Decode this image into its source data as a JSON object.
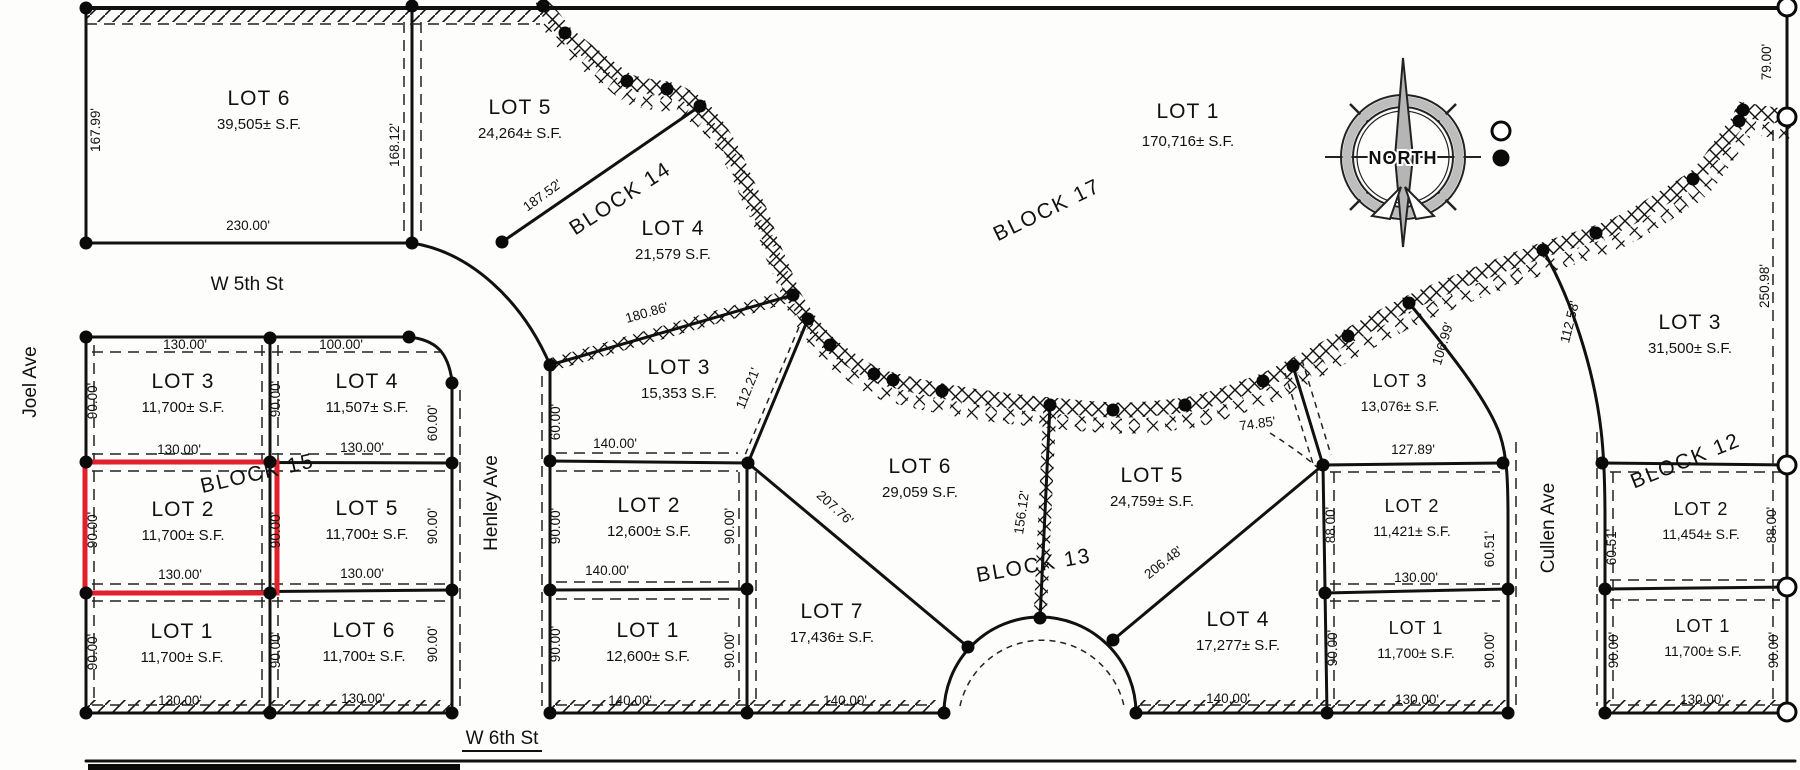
{
  "compass": {
    "label": "NORTH"
  },
  "highlight": {
    "color": "#e0202a"
  },
  "streets": [
    {
      "id": "w-5th-st",
      "label": "W 5th St",
      "x": 247,
      "y": 290,
      "r": 0
    },
    {
      "id": "joel-ave",
      "label": "Joel Ave",
      "x": 36,
      "y": 382,
      "r": -90
    },
    {
      "id": "henley-ave",
      "label": "Henley Ave",
      "x": 497,
      "y": 503,
      "r": -90
    },
    {
      "id": "cullen-ave",
      "label": "Cullen Ave",
      "x": 1554,
      "y": 528,
      "r": -90
    },
    {
      "id": "w-6th-st",
      "label": "W 6th St",
      "x": 502,
      "y": 744,
      "r": 0,
      "underline": true
    }
  ],
  "blocks": [
    {
      "id": "block-14",
      "label": "BLOCK  14",
      "x": 624,
      "y": 204,
      "r": -33
    },
    {
      "id": "block-15",
      "label": "BLOCK  15",
      "x": 259,
      "y": 480,
      "r": -13
    },
    {
      "id": "block-17",
      "label": "BLOCK  17",
      "x": 1050,
      "y": 216,
      "r": -26
    },
    {
      "id": "block-13",
      "label": "BLOCK  13",
      "x": 1035,
      "y": 572,
      "r": -10
    },
    {
      "id": "block-12",
      "label": "BLOCK  12",
      "x": 1688,
      "y": 467,
      "r": -22
    }
  ],
  "lots": [
    {
      "id": "b14-lot6",
      "name": "LOT 6",
      "area": "39,505± S.F.",
      "x": 259,
      "y": 105
    },
    {
      "id": "b14-lot5",
      "name": "LOT 5",
      "area": "24,264± S.F.",
      "x": 520,
      "y": 114
    },
    {
      "id": "b14-lot4",
      "name": "LOT 4",
      "area": "21,579 S.F.",
      "x": 673,
      "y": 235
    },
    {
      "id": "b14-lot3",
      "name": "LOT 3",
      "area": "15,353 S.F.",
      "x": 679,
      "y": 374
    },
    {
      "id": "b17-lot1",
      "name": "LOT 1",
      "area": "170,716± S.F.",
      "x": 1188,
      "y": 118,
      "gap": 28
    },
    {
      "id": "b15-lot3",
      "name": "LOT 3",
      "area": "11,700± S.F.",
      "x": 183,
      "y": 388
    },
    {
      "id": "b15-lot4",
      "name": "LOT 4",
      "area": "11,507± S.F.",
      "x": 367,
      "y": 388
    },
    {
      "id": "b15-lot2",
      "name": "LOT 2",
      "area": "11,700± S.F.",
      "x": 183,
      "y": 516,
      "highlighted": true
    },
    {
      "id": "b15-lot5",
      "name": "LOT 5",
      "area": "11,700± S.F.",
      "x": 367,
      "y": 515
    },
    {
      "id": "b15-lot1",
      "name": "LOT 1",
      "area": "11,700± S.F.",
      "x": 182,
      "y": 638
    },
    {
      "id": "b15-lot6",
      "name": "LOT 6",
      "area": "11,700± S.F.",
      "x": 364,
      "y": 637
    },
    {
      "id": "b13-lot2-west",
      "name": "LOT 2",
      "area": "12,600± S.F.",
      "x": 649,
      "y": 512
    },
    {
      "id": "b13-lot1-west",
      "name": "LOT 1",
      "area": "12,600± S.F.",
      "x": 648,
      "y": 637
    },
    {
      "id": "b13-lot7",
      "name": "LOT 7",
      "area": "17,436± S.F.",
      "x": 832,
      "y": 618
    },
    {
      "id": "b13-lot6",
      "name": "LOT 6",
      "area": "29,059 S.F.",
      "x": 920,
      "y": 473
    },
    {
      "id": "b13-lot5",
      "name": "LOT 5",
      "area": "24,759± S.F.",
      "x": 1152,
      "y": 482
    },
    {
      "id": "b13-lot4",
      "name": "LOT 4",
      "area": "17,277± S.F.",
      "x": 1238,
      "y": 626
    },
    {
      "id": "b13-lot3",
      "name": "LOT 3",
      "area": "13,076± S.F.",
      "x": 1400,
      "y": 387,
      "small": true
    },
    {
      "id": "b13-lot2-east",
      "name": "LOT 2",
      "area": "11,421± S.F.",
      "x": 1412,
      "y": 512,
      "small": true
    },
    {
      "id": "b13-lot1-east",
      "name": "LOT 1",
      "area": "11,700± S.F.",
      "x": 1416,
      "y": 634,
      "small": true
    },
    {
      "id": "b12-lot3",
      "name": "LOT 3",
      "area": "31,500± S.F.",
      "x": 1690,
      "y": 329
    },
    {
      "id": "b12-lot2",
      "name": "LOT 2",
      "area": "11,454± S.F.",
      "x": 1701,
      "y": 515,
      "small": true
    },
    {
      "id": "b12-lot1",
      "name": "LOT 1",
      "area": "11,700± S.F.",
      "x": 1703,
      "y": 632,
      "small": true
    }
  ],
  "dimensions": [
    {
      "t": "167.99'",
      "x": 100,
      "y": 130,
      "r": -90
    },
    {
      "t": "230.00'",
      "x": 248,
      "y": 230
    },
    {
      "t": "168.12'",
      "x": 399,
      "y": 145,
      "r": -90
    },
    {
      "t": "187.52'",
      "x": 545,
      "y": 199,
      "r": -36
    },
    {
      "t": "180.86'",
      "x": 648,
      "y": 317,
      "r": -16
    },
    {
      "t": "112.21'",
      "x": 752,
      "y": 390,
      "r": -68
    },
    {
      "t": "79.00'",
      "x": 1771,
      "y": 62,
      "r": -90
    },
    {
      "t": "250.98'",
      "x": 1769,
      "y": 286,
      "r": -90
    },
    {
      "t": "106.99'",
      "x": 1447,
      "y": 345,
      "r": -73
    },
    {
      "t": "112.58'",
      "x": 1574,
      "y": 323,
      "r": -76
    },
    {
      "t": "74.85'",
      "x": 1258,
      "y": 428,
      "r": -8
    },
    {
      "t": "127.89'",
      "x": 1413,
      "y": 454
    },
    {
      "t": "130.00'",
      "x": 185,
      "y": 349
    },
    {
      "t": "100.00'",
      "x": 341,
      "y": 349
    },
    {
      "t": "90.00'",
      "x": 97,
      "y": 401,
      "r": -90
    },
    {
      "t": "90.00'",
      "x": 280,
      "y": 399,
      "r": -90
    },
    {
      "t": "130.00'",
      "x": 179,
      "y": 454
    },
    {
      "t": "130.00'",
      "x": 362,
      "y": 452
    },
    {
      "t": "60.00'",
      "x": 437,
      "y": 423,
      "r": -90
    },
    {
      "t": "60.00'",
      "x": 560,
      "y": 422,
      "r": -90
    },
    {
      "t": "140.00'",
      "x": 615,
      "y": 448
    },
    {
      "t": "90.00'",
      "x": 97,
      "y": 530,
      "r": -90
    },
    {
      "t": "90.00'",
      "x": 280,
      "y": 530,
      "r": -90
    },
    {
      "t": "90.00'",
      "x": 437,
      "y": 526,
      "r": -90
    },
    {
      "t": "90.00'",
      "x": 560,
      "y": 526,
      "r": -90
    },
    {
      "t": "90.00'",
      "x": 734,
      "y": 526,
      "r": -90
    },
    {
      "t": "130.00'",
      "x": 180,
      "y": 579
    },
    {
      "t": "130.00'",
      "x": 362,
      "y": 578
    },
    {
      "t": "140.00'",
      "x": 607,
      "y": 575
    },
    {
      "t": "90.00'",
      "x": 97,
      "y": 652,
      "r": -90
    },
    {
      "t": "90.00'",
      "x": 280,
      "y": 650,
      "r": -90
    },
    {
      "t": "90.00'",
      "x": 437,
      "y": 644,
      "r": -90
    },
    {
      "t": "90.00'",
      "x": 560,
      "y": 644,
      "r": -90
    },
    {
      "t": "90.00'",
      "x": 734,
      "y": 650,
      "r": -90
    },
    {
      "t": "130.00'",
      "x": 180,
      "y": 705
    },
    {
      "t": "130.00'",
      "x": 363,
      "y": 703
    },
    {
      "t": "140.00'",
      "x": 630,
      "y": 705
    },
    {
      "t": "140.00'",
      "x": 845,
      "y": 705
    },
    {
      "t": "207.76'",
      "x": 832,
      "y": 511,
      "r": 42
    },
    {
      "t": "156.12'",
      "x": 1026,
      "y": 513,
      "r": -82
    },
    {
      "t": "206.48'",
      "x": 1166,
      "y": 566,
      "r": -38
    },
    {
      "t": "88.00'",
      "x": 1335,
      "y": 525,
      "r": -90
    },
    {
      "t": "60.51'",
      "x": 1494,
      "y": 549,
      "r": -90
    },
    {
      "t": "130.00'",
      "x": 1416,
      "y": 582
    },
    {
      "t": "90.00'",
      "x": 1337,
      "y": 648,
      "r": -90
    },
    {
      "t": "90.00'",
      "x": 1494,
      "y": 650,
      "r": -90
    },
    {
      "t": "130.00'",
      "x": 1417,
      "y": 704
    },
    {
      "t": "140.00'",
      "x": 1228,
      "y": 703
    },
    {
      "t": "60.51'",
      "x": 1616,
      "y": 547,
      "r": -90
    },
    {
      "t": "88.00'",
      "x": 1776,
      "y": 525,
      "r": -90
    },
    {
      "t": "90.00'",
      "x": 1618,
      "y": 650,
      "r": -90
    },
    {
      "t": "90.00'",
      "x": 1778,
      "y": 650,
      "r": -90
    },
    {
      "t": "130.00'",
      "x": 1702,
      "y": 704
    }
  ]
}
